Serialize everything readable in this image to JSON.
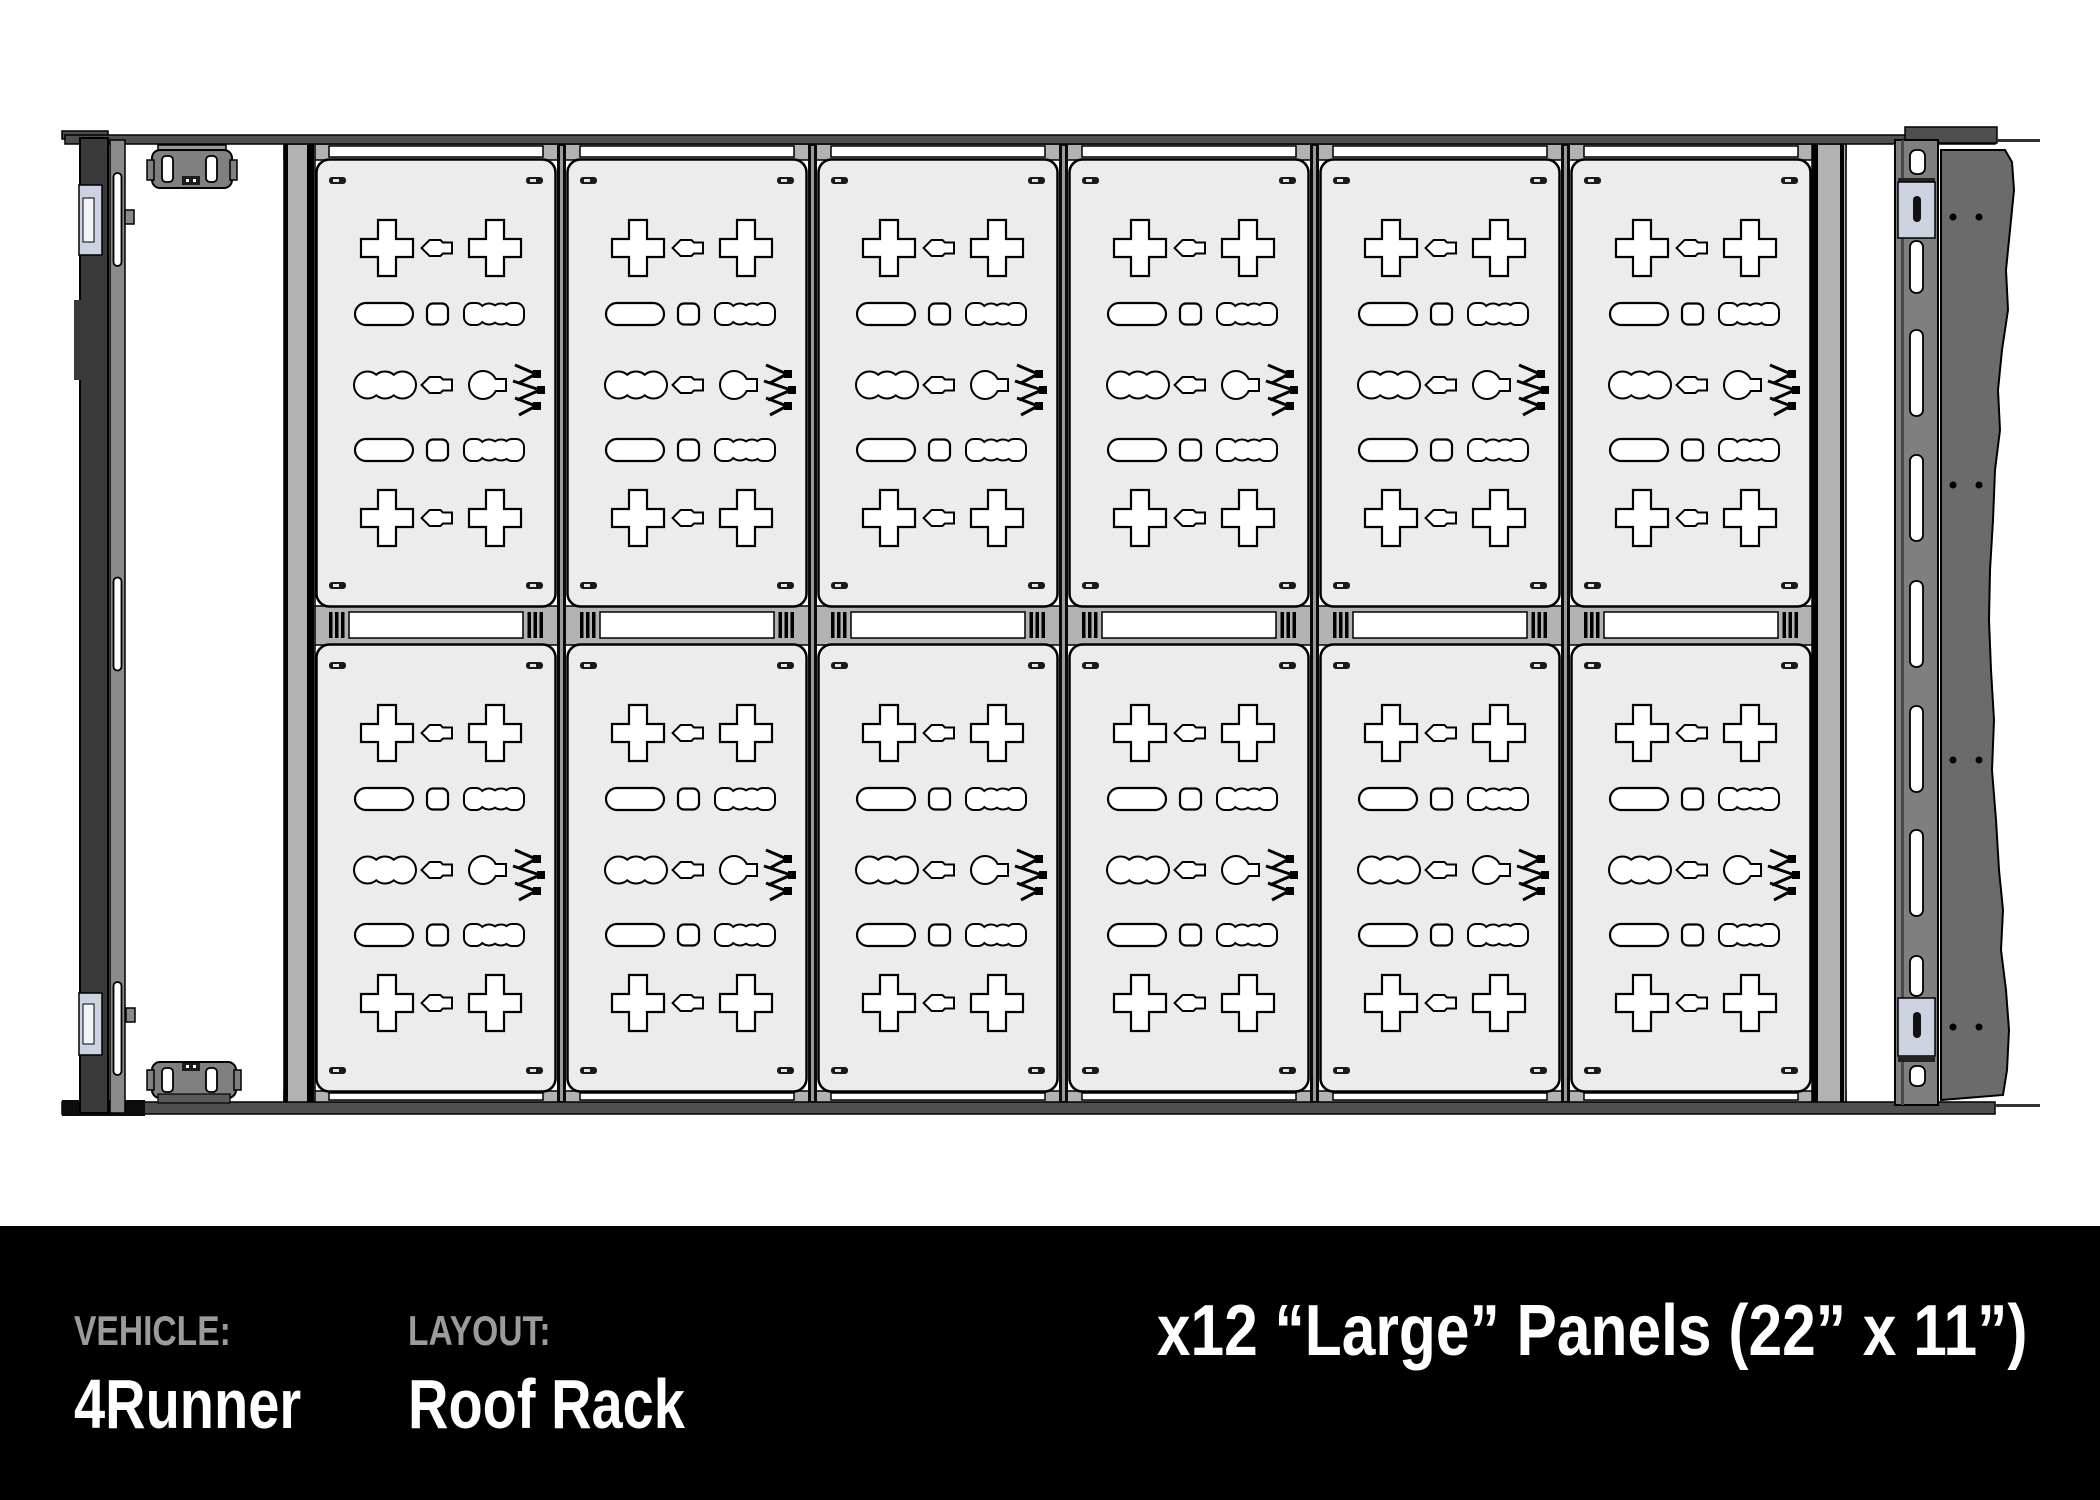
{
  "footer": {
    "vehicle_label": "VEHICLE:",
    "vehicle_value": "4Runner",
    "layout_label": "LAYOUT:",
    "layout_value": "Roof Rack",
    "panels_note": "x12 “Large” Panels (22” x 11”)"
  },
  "rack": {
    "rows": 2,
    "columns": 6,
    "panel_count": 12,
    "left_rail_slots": 3,
    "right_rail_slots": 7,
    "fairing_dot_rows": 4,
    "panel_cutouts": [
      "cross-slot",
      "hex-connector-slot",
      "pill-slot",
      "rounded-square-slot",
      "chain-link-slot",
      "circle-tab-slot",
      "zigzag-logo-cutout"
    ]
  },
  "colors": {
    "panel_fill": "#ececec",
    "frame_gray": "#b2b2b2",
    "band_dark": "#4f4f4f",
    "rail_dark": "#3a3a3a",
    "mid_gray": "#8a8a8a",
    "slot_rail": "#7f7f7f",
    "fairing": "#6b6b6b",
    "bracket_slate": "#ccd2df",
    "footer_bg": "#000000",
    "label_gray": "#9b9b9b",
    "text_white": "#ffffff"
  }
}
